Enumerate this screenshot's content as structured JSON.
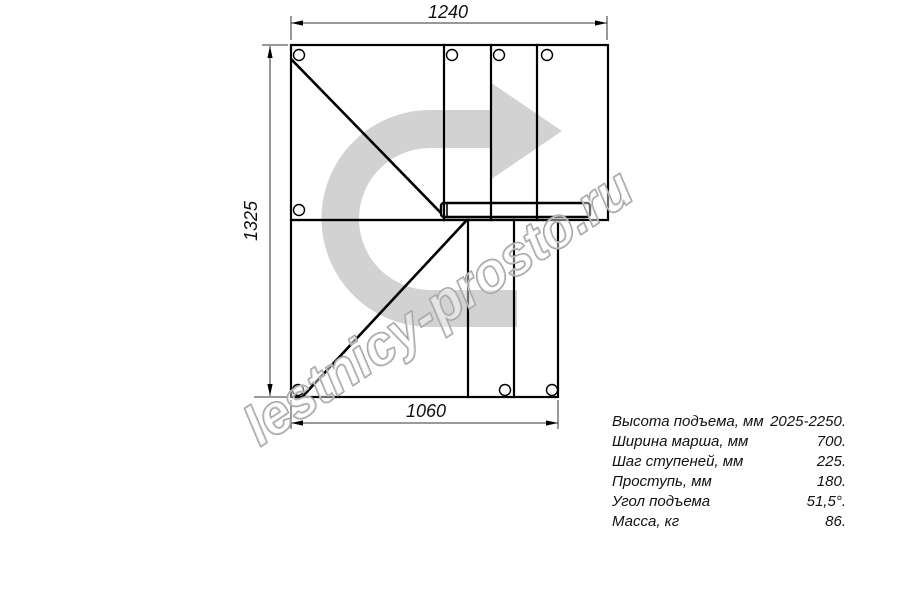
{
  "drawing": {
    "title": "staircase-plan-top-view",
    "dimensions": {
      "top": "1240",
      "left": "1325",
      "bottom": "1060"
    },
    "watermark": "lestnicy-prosto.ru",
    "colors": {
      "arrow_gray": "#d2d2d2",
      "line_black": "#000000",
      "watermark_gray": "#9f9f9f"
    }
  },
  "specs": {
    "rows": [
      {
        "label": "Высота подъема, мм",
        "value": "2025-2250."
      },
      {
        "label": "Ширина марша, мм",
        "value": "700."
      },
      {
        "label": "Шаг ступеней, мм",
        "value": "225."
      },
      {
        "label": "Проступь, мм",
        "value": "180."
      },
      {
        "label": "Угол подъема",
        "value": "51,5°."
      },
      {
        "label": "Масса, кг",
        "value": "86."
      }
    ]
  }
}
